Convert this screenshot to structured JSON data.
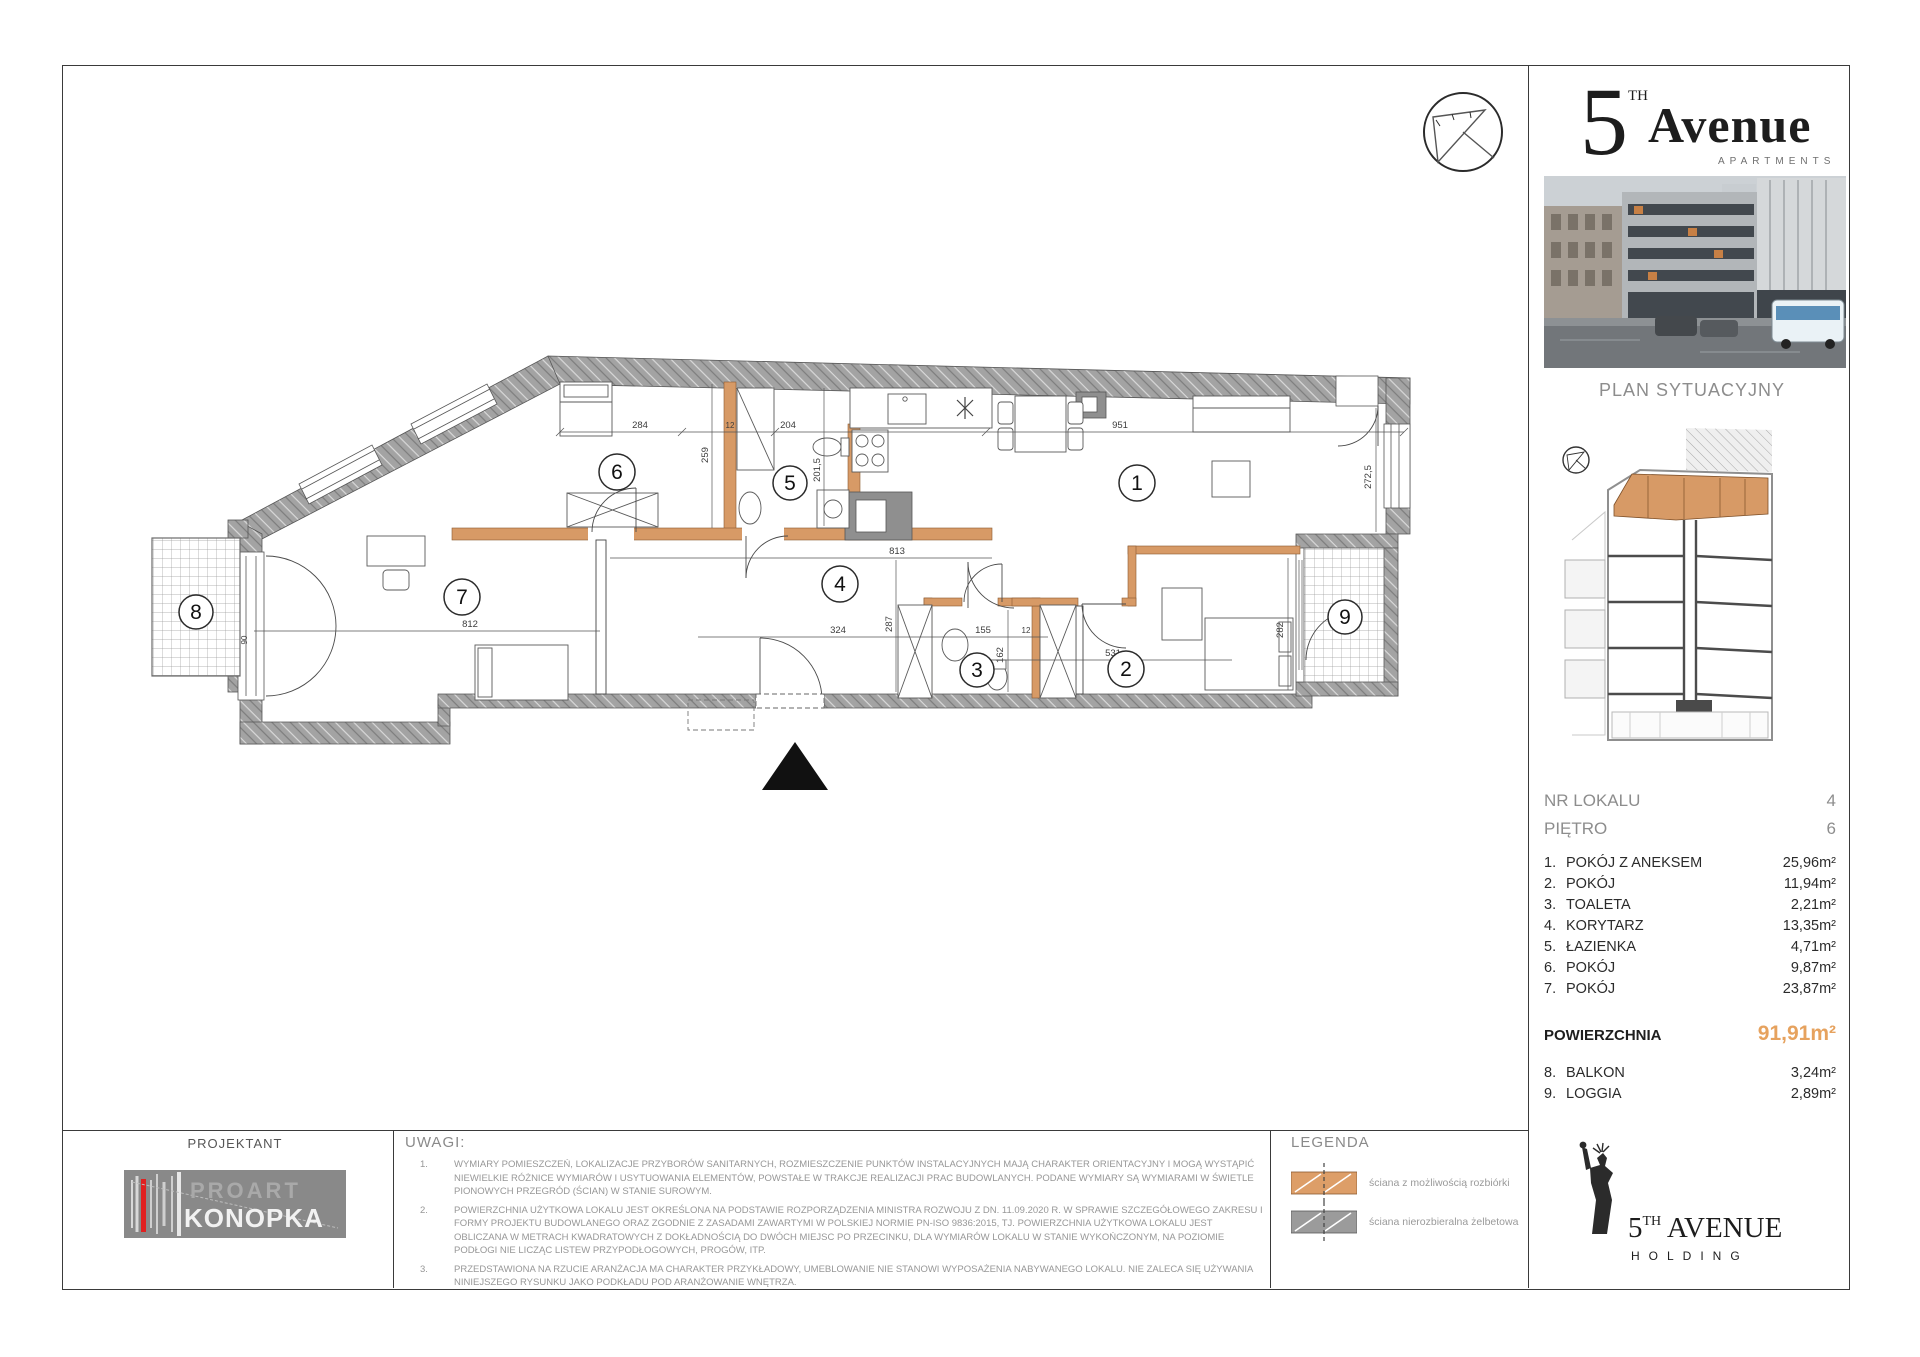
{
  "sidebar": {
    "brand": {
      "digit": "5",
      "sup": "TH",
      "word": "Avenue",
      "subtitle": "APARTMENTS"
    },
    "plan_title": "PLAN SYTUACYJNY",
    "info_rows": [
      {
        "label": "NR LOKALU",
        "value": "4"
      },
      {
        "label": "PIĘTRO",
        "value": "6"
      }
    ],
    "rooms": [
      {
        "no": "1.",
        "name": "POKÓJ Z ANEKSEM",
        "area": "25,96m²"
      },
      {
        "no": "2.",
        "name": "POKÓJ",
        "area": "11,94m²"
      },
      {
        "no": "3.",
        "name": "TOALETA",
        "area": "2,21m²"
      },
      {
        "no": "4.",
        "name": "KORYTARZ",
        "area": "13,35m²"
      },
      {
        "no": "5.",
        "name": "ŁAZIENKA",
        "area": "4,71m²"
      },
      {
        "no": "6.",
        "name": "POKÓJ",
        "area": "9,87m²"
      },
      {
        "no": "7.",
        "name": "POKÓJ",
        "area": "23,87m²"
      }
    ],
    "total": {
      "label": "POWIERZCHNIA",
      "value": "91,91m²"
    },
    "extras": [
      {
        "no": "8.",
        "name": "BALKON",
        "area": "3,24m²"
      },
      {
        "no": "9.",
        "name": "LOGGIA",
        "area": "2,89m²"
      }
    ],
    "holding": {
      "digit": "5",
      "sup": "TH",
      "name": " AVENUE",
      "line2": "HOLDING"
    }
  },
  "plan": {
    "room_numbers": [
      "1",
      "2",
      "3",
      "4",
      "5",
      "6",
      "7",
      "8",
      "9"
    ],
    "dimensions": [
      "284",
      "12",
      "204",
      "951",
      "259",
      "201,5",
      "813",
      "287",
      "324",
      "12",
      "155",
      "162",
      "531",
      "282",
      "272,5",
      "812",
      "90"
    ]
  },
  "footer": {
    "projektant_label": "PROJEKTANT",
    "logo": {
      "line1": "PROART",
      "line2": "KONOPKA"
    },
    "uwagi_title": "UWAGI:",
    "notes": [
      {
        "no": "1.",
        "text": "WYMIARY POMIESZCZEŃ, LOKALIZACJE PRZYBORÓW SANITARNYCH, ROZMIESZCZENIE PUNKTÓW INSTALACYJNYCH MAJĄ CHARAKTER ORIENTACYJNY I MOGĄ WYSTĄPIĆ NIEWIELKIE RÓŻNICE WYMIARÓW I USYTUOWANIA ELEMENTÓW, POWSTAŁE W TRAKCJE REALIZACJI PRAC BUDOWLANYCH. PODANE WYMIARY SĄ WYMIARAMI W ŚWIETLE PIONOWYCH PRZEGRÓD (ŚCIAN) W STANIE SUROWYM."
      },
      {
        "no": "2.",
        "text": "POWIERZCHNIA UŻYTKOWA LOKALU JEST OKREŚLONA NA PODSTAWIE ROZPORZĄDZENIA MINISTRA ROZWOJU Z DN. 11.09.2020 R. W SPRAWIE SZCZEGÓŁOWEGO ZAKRESU I FORMY PROJEKTU BUDOWLANEGO ORAZ ZGODNIE Z ZASADAMI ZAWARTYMI W POLSKIEJ NORMIE PN-ISO 9836:2015, TJ. POWIERZCHNIA UŻYTKOWA LOKALU JEST OBLICZANA W METRACH KWADRATOWYCH Z DOKŁADNOŚCIĄ DO DWÓCH MIEJSC PO PRZECINKU, DLA WYMIARÓW LOKALU W STANIE WYKOŃCZONYM, NA POZIOMIE PODŁOGI NIE LICZĄC LISTEW PRZYPODŁOGOWYCH, PROGÓW, ITP."
      },
      {
        "no": "3.",
        "text": "PRZEDSTAWIONA NA RZUCIE ARANŻACJA MA CHARAKTER PRZYKŁADOWY, UMEBLOWANIE NIE STANOWI WYPOSAŻENIA NABYWANEGO LOKALU. NIE ZALECA SIĘ UŻYWANIA NINIEJSZEGO RYSUNKU JAKO PODKŁADU POD ARANŻOWANIE WNĘTRZA."
      }
    ],
    "legenda_title": "LEGENDA",
    "legend": [
      {
        "label": "ściana z możliwością rozbiórki",
        "color": "#dd9e68"
      },
      {
        "label": "ściana nierozbieralna żelbetowa",
        "color": "#9b9b9b"
      }
    ]
  },
  "colors": {
    "wall_orange": "#d79a66",
    "wall_gray": "#9c9c9c",
    "accent_orange": "#e6a25e"
  }
}
